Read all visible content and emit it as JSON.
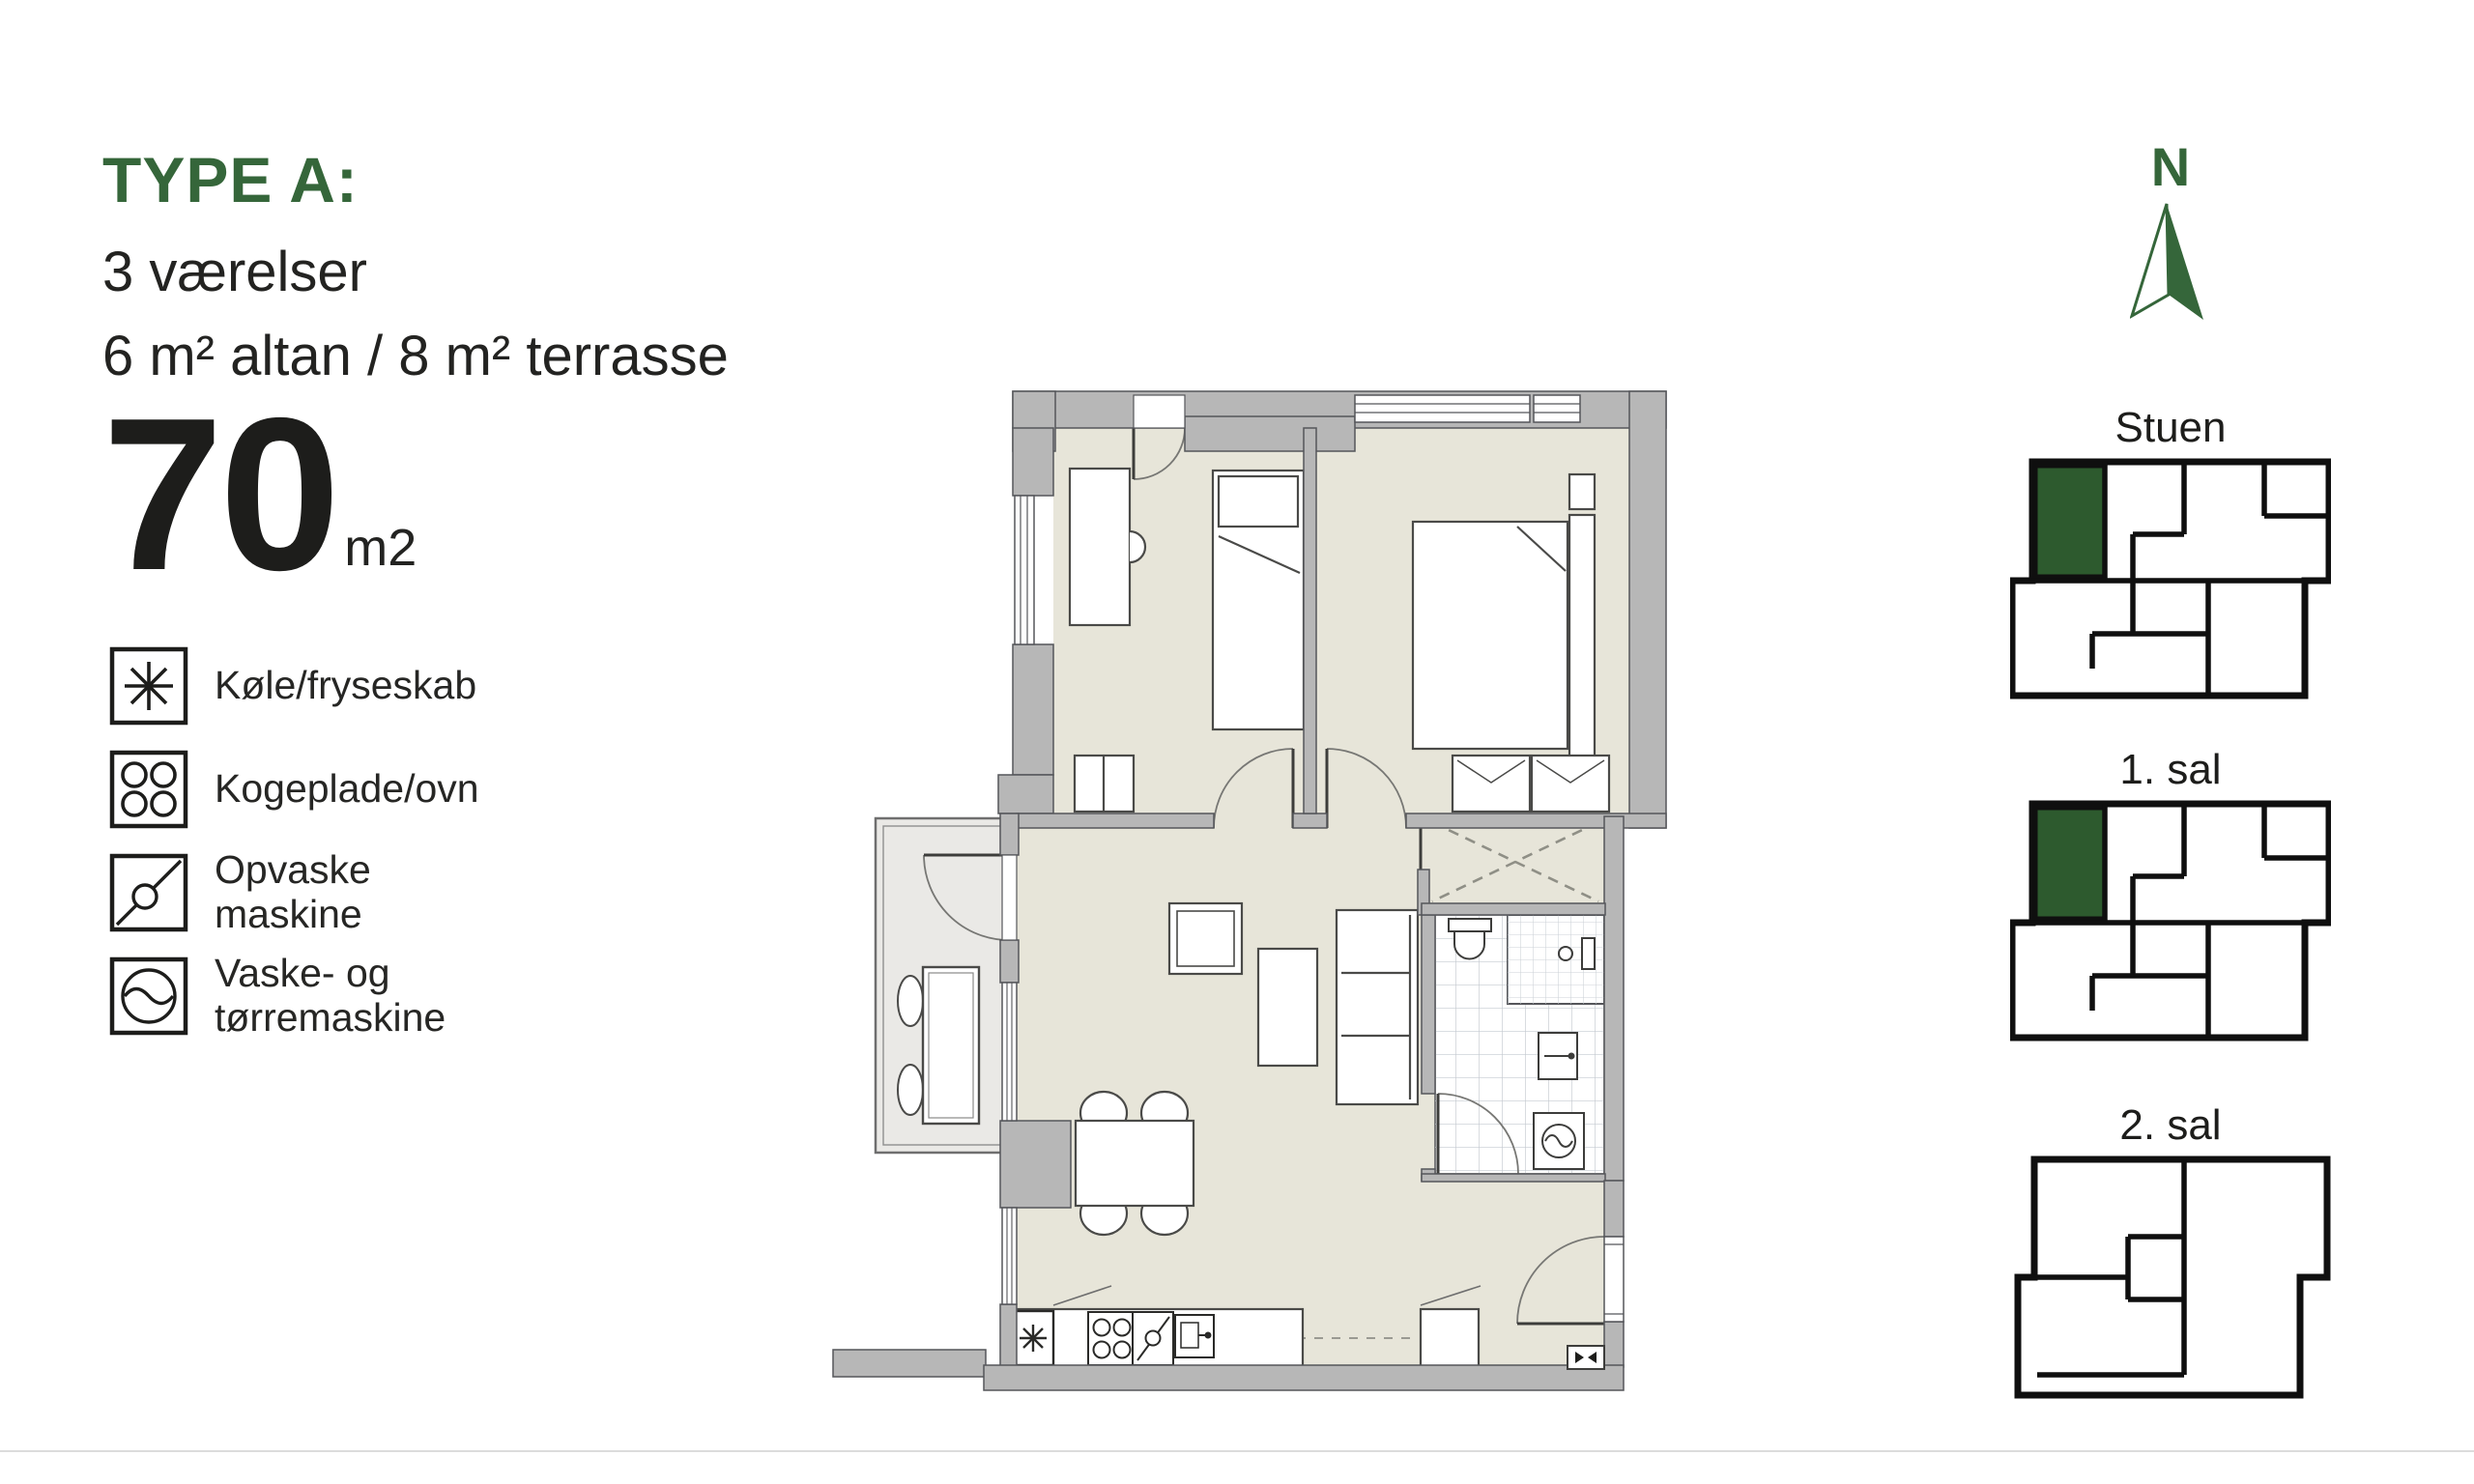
{
  "title": {
    "type_label": "TYPE A:",
    "rooms_line": "3 værelser",
    "outdoor_line": "6 m² altan / 8 m² terrasse",
    "area_value": "70",
    "area_unit": "m2"
  },
  "legend": {
    "items": [
      {
        "icon": "fridge-freezer-icon",
        "label": "Køle/fryseskab"
      },
      {
        "icon": "hob-oven-icon",
        "label": "Kogeplade/ovn"
      },
      {
        "icon": "dishwasher-icon",
        "label_line1": "Opvaske",
        "label_line2": "maskine"
      },
      {
        "icon": "washer-dryer-icon",
        "label_line1": "Vaske- og",
        "label_line2": "tørremaskine"
      }
    ]
  },
  "compass": {
    "label": "N"
  },
  "floors": [
    {
      "label": "Stuen",
      "highlighted": true
    },
    {
      "label": "1. sal",
      "highlighted": true
    },
    {
      "label": "2. sal",
      "highlighted": false
    }
  ],
  "colors": {
    "accent_green": "#35663A",
    "unit_green": "#2D5A2E",
    "wall_gray": "#b7b7b7",
    "floor_beige": "#e7e5d9",
    "balcony_gray": "#eae9e6",
    "text_dark": "#1d1d1b"
  }
}
